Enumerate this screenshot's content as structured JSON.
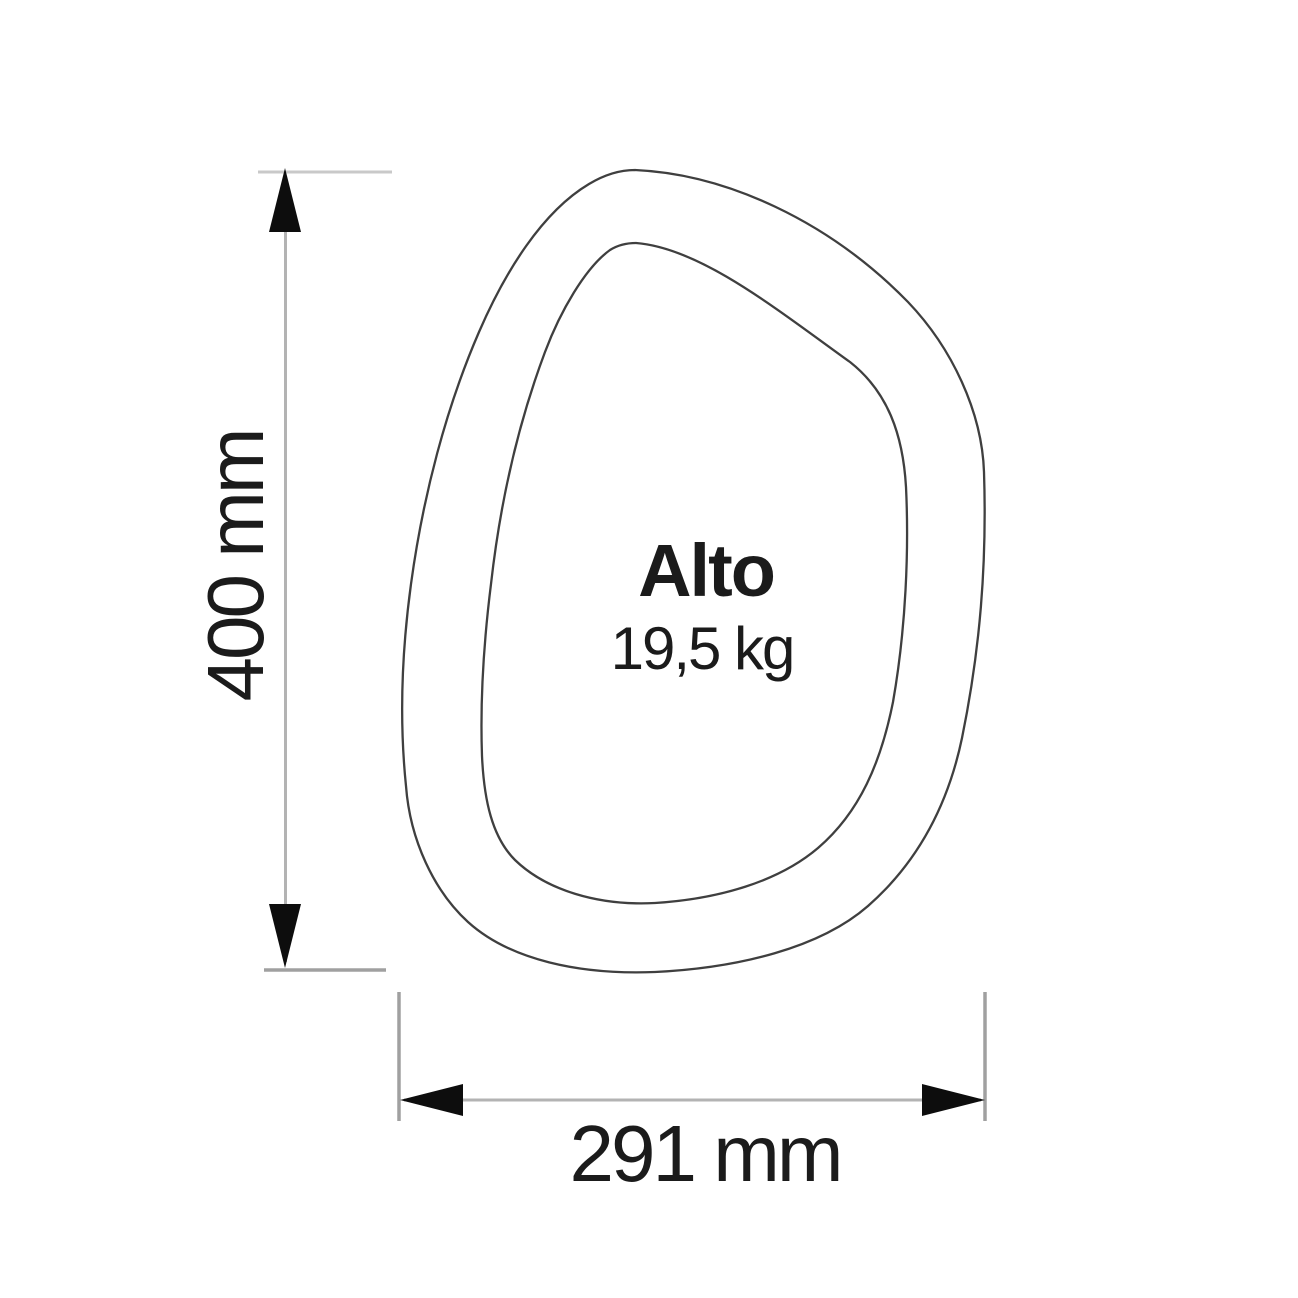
{
  "diagram": {
    "type": "product-dimension-drawing",
    "product_name": "Alto",
    "weight": "19,5 kg",
    "dimensions": {
      "height": "400 mm",
      "width": "291 mm"
    }
  },
  "colors": {
    "background": "#ffffff",
    "shape_line": "#3f3f3f",
    "dim_line": "#b3b3b3",
    "ext_line": "#a0a0a0",
    "ext_line_light": "#c9c9c9",
    "arrow": "#0d0d0d",
    "text": "#1b1b1b"
  }
}
